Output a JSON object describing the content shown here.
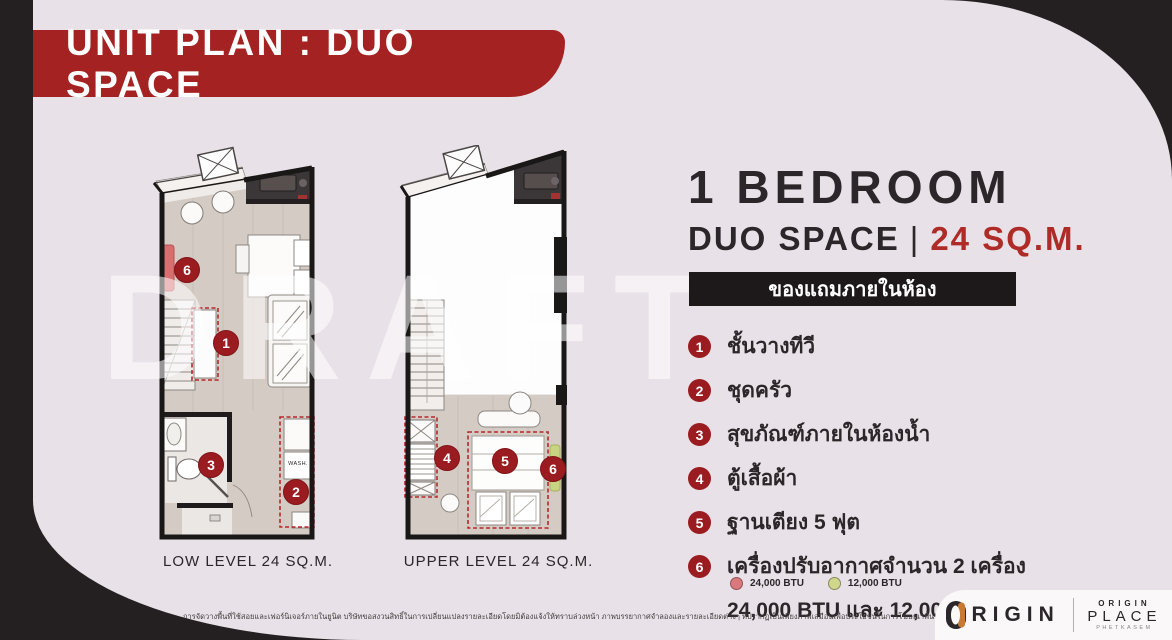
{
  "banner": {
    "title": "UNIT PLAN : DUO SPACE"
  },
  "watermark": "DRAFT",
  "plans": [
    {
      "name": "low-level",
      "label": "LOW LEVEL 24 SQ.M.",
      "wash_label": "WASH.",
      "markers": [
        "6",
        "1",
        "3",
        "2"
      ]
    },
    {
      "name": "upper-level",
      "label": "UPPER LEVEL 24 SQ.M.",
      "markers": [
        "4",
        "5",
        "6"
      ]
    }
  ],
  "details": {
    "title": "1 BEDROOM",
    "subtitle": "DUO SPACE",
    "subtitle_divider": "|",
    "subtitle_area": "24 SQ.M.",
    "section_header": "ของแถมภายในห้อง",
    "items": [
      {
        "num": "1",
        "text": "ชั้นวางทีวี"
      },
      {
        "num": "2",
        "text": "ชุดครัว"
      },
      {
        "num": "3",
        "text": "สุขภัณฑ์ภายในห้องน้ำ"
      },
      {
        "num": "4",
        "text": "ตู้เสื้อผ้า"
      },
      {
        "num": "5",
        "text": "ฐานเตียง 5 ฟุต"
      },
      {
        "num": "6",
        "text": "เครื่องปรับอากาศจำนวน 2 เครื่อง",
        "text_line2": "24,000 BTU และ 12,000 BTU"
      }
    ],
    "legend": [
      {
        "label": "24,000 BTU",
        "color": "#d9797c"
      },
      {
        "label": "12,000 BTU",
        "color": "#cdd88b"
      }
    ]
  },
  "footer": {
    "disclaimer": "การจัดวางพื้นที่ใช้สอยและเฟอร์นิเจอร์ภายในยูนิต บริษัทขอสงวนสิทธิ์ในการเปลี่ยนแปลงรายละเอียดโดยมิต้องแจ้งให้ทราบล่วงหน้า ภาพบรรยากาศจำลองและรายละเอียดต่างๆ ที่ปรากฏเป็นเพียงภาพเสมือนเพื่อประโยชน์ในการโฆษณาพื้นที่ใช้สอยเท่านั้น",
    "brand": {
      "origin_wordmark": "RIGIN",
      "place_line1": "ORIGIN",
      "place_line2": "PLACE",
      "place_line3": "PHETKASEM"
    }
  },
  "colors": {
    "background": "#242022",
    "page": "#e8e1e7",
    "banner_red": "#a42322",
    "accent_red": "#af2b27",
    "marker_red": "#9b1c20",
    "header_bar": "#1d191a",
    "ac_red": "#d76e70",
    "ac_green": "#c9d483"
  }
}
